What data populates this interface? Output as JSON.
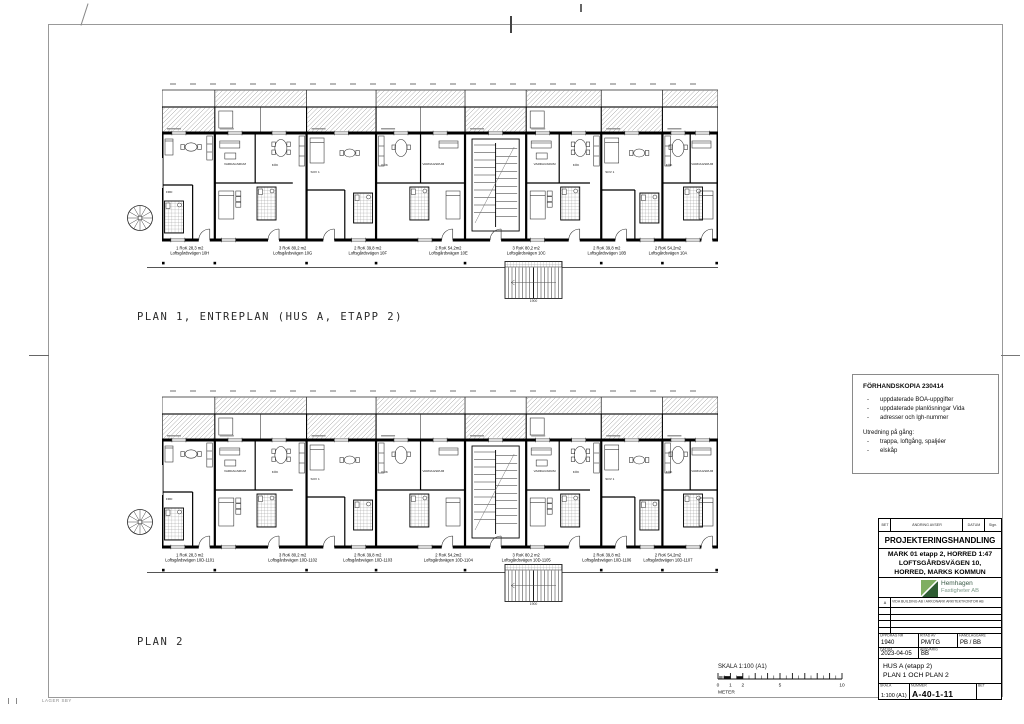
{
  "page": {
    "plan1_label": "PLAN 1, ENTREPLAN (HUS A, ETAPP 2)",
    "plan2_label": "PLAN 2",
    "corner_label": "LAGER SBY"
  },
  "plan1": {
    "apartments": [
      {
        "type": "1 RoK 28,3 m2",
        "address": "Loftsgårdsvägen 10H"
      },
      {
        "type": "3 RoK 80,2 m2",
        "address": "Loftsgårdsvägen 10G"
      },
      {
        "type": "2 RoK 39,8 m2",
        "address": "Loftsgårdsvägen 10F"
      },
      {
        "type": "2 RoK 54,2m2",
        "address": "Loftsgårdsvägen 10E"
      },
      {
        "type": "3 RoK 80,2 m2",
        "address": "Loftsgårdsvägen 10C"
      },
      {
        "type": "2 RoK 39,8 m2",
        "address": "Loftsgårdsvägen 10B"
      },
      {
        "type": "2 RoK 54,2m2",
        "address": "Loftsgårdsvägen 10A"
      }
    ]
  },
  "plan2": {
    "apartments": [
      {
        "type": "1 RoK 28,3 m2",
        "address": "Loftsgårdsvägen 10D-1101"
      },
      {
        "type": "3 RoK 80,2 m2",
        "address": "Loftsgårdsvägen 10D-1102"
      },
      {
        "type": "2 RoK 39,8 m2",
        "address": "Loftsgårdsvägen 10D-1103"
      },
      {
        "type": "2 RoK 54,2m2",
        "address": "Loftsgårdsvägen 10D-1104"
      },
      {
        "type": "3 RoK 80,2 m2",
        "address": "Loftsgårdsvägen 10D-1105"
      },
      {
        "type": "2 RoK 39,8 m2",
        "address": "Loftsgårdsvägen 10D-1106"
      },
      {
        "type": "2 RoK 54,2m2",
        "address": "Loftsgårdsvägen 10D-1107"
      }
    ]
  },
  "rooms": {
    "livingroom": "VARDAGSRUM",
    "kitchen": "KÖK",
    "bedroom": "SOV 1",
    "bath": "BAD",
    "storage": "FRD",
    "shed": "SKJUL",
    "stair_dim": "1900"
  },
  "notes": {
    "title": "FÖRHANDSKOPIA 230414",
    "bullet": "-",
    "items": [
      "uppdaterade BOA-uppgifter",
      "uppdaterade planlösningar Vida",
      "adresser och lgh-nummer"
    ],
    "subtitle": "Utredning på gång:",
    "items2": [
      "trappa, loftgång, spaljéer",
      "elskåp"
    ]
  },
  "scalebar": {
    "label": "SKALA 1:100 (A1)",
    "unit": "METER",
    "ticks": [
      "0",
      "1",
      "2",
      "5",
      "10"
    ]
  },
  "titleblock": {
    "header": {
      "bet": "BET",
      "andring": "ÄNDRING AVSER",
      "datum": "DATUM",
      "sign": "Sign."
    },
    "doc_type": "PROJEKTERINGSHANDLING",
    "project_lines": [
      "MARK 01 etapp 2, HORRED 1:47",
      "LOFTSGÅRDSVÄGEN 10,",
      "HORRED, MARKS KOMMUN"
    ],
    "logo": {
      "name_line1": "Hemhagen",
      "name_line2": "Fastigheter AB",
      "green_light": "#7fae62",
      "green_dark": "#2f5d33"
    },
    "revision": {
      "letter": "A",
      "text": "VIDA BUILDING AB / ARKONARK ARKITEKTKONTOR AB"
    },
    "fields": {
      "uppdrag_label": "UPPDRAG NR",
      "uppdrag": "1940",
      "ritad_label": "RITAD AV",
      "ritad": "PM/TG",
      "handl_label": "HANDLÄGGARE",
      "handl": "PB / BB",
      "datum_label": "DATUM",
      "datum": "2023-04-05",
      "ansvarig_label": "ANSVARIG",
      "ansvarig": "BB"
    },
    "title_lines": [
      "HUS A (etapp 2)",
      "PLAN 1 OCH PLAN 2"
    ],
    "bottom": {
      "skala_label": "SKALA",
      "skala": "1:100 (A1)",
      "nummer_label": "NUMMER",
      "nummer": "A-40-1-11",
      "bet_label": "BET"
    }
  }
}
